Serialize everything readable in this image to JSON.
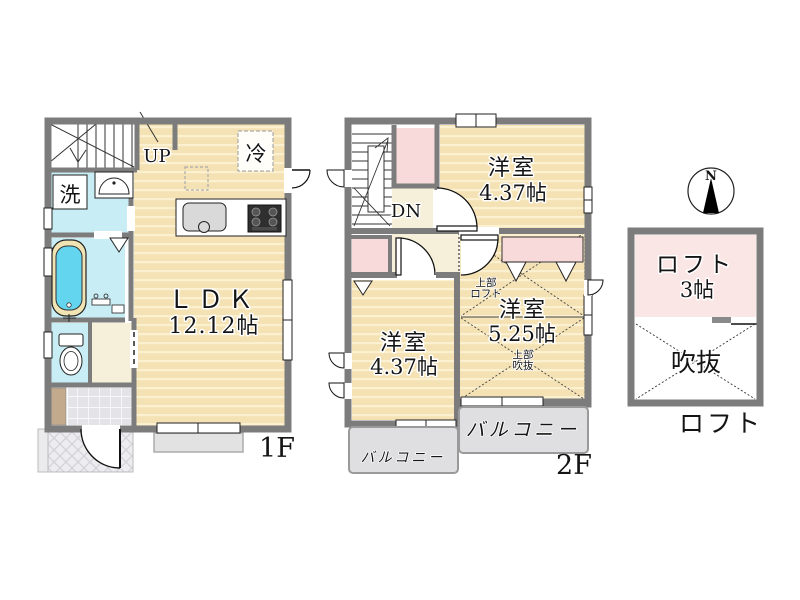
{
  "floor1": {
    "caption": "1F",
    "stairs_label": "UP",
    "ldk_name": "ＬＤＫ",
    "ldk_size": "12.12帖",
    "wash_label": "洗",
    "fridge_label": "冷"
  },
  "floor2": {
    "caption": "2F",
    "stairs_label": "DN",
    "bedroom_top_name": "洋室",
    "bedroom_top_size": "4.37帖",
    "bedroom_left_name": "洋室",
    "bedroom_left_size": "4.37帖",
    "bedroom_right_name": "洋室",
    "bedroom_right_size": "5.25帖",
    "upper_loft_line1": "上部",
    "upper_loft_line2": "ロフト",
    "upper_void_line1": "上部",
    "upper_void_line2": "吹抜",
    "balcony_left_label": "バルコニー",
    "balcony_right_label": "バルコニー"
  },
  "loft": {
    "caption": "ロフト",
    "room_name": "ロフト",
    "room_size": "3帖",
    "void_label": "吹抜"
  },
  "compass": {
    "north": "N"
  },
  "colors": {
    "floor": "#F5E2B4",
    "wet_area": "#C8EDF5",
    "closet_pink": "#F9DADA",
    "loft_pink": "#FBE6E6",
    "wall": "#7C7C7C",
    "balcony": "#DFDFE1",
    "tub_water": "#63D5EE"
  }
}
